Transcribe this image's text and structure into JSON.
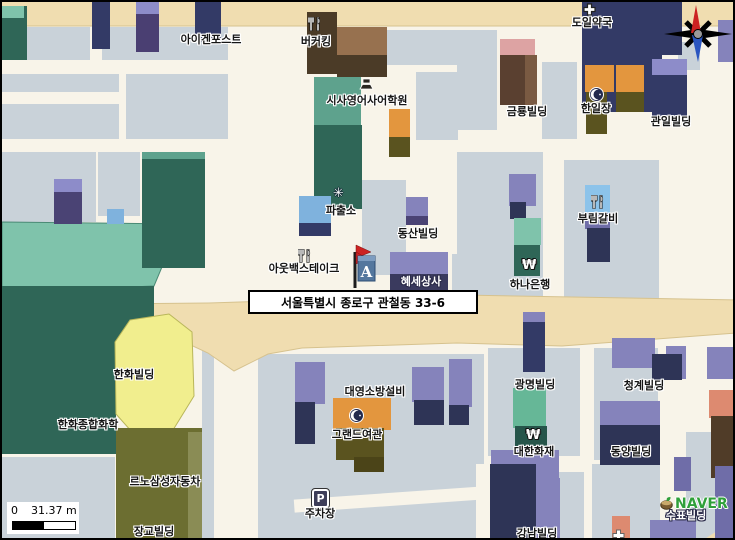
{
  "map": {
    "title_address": "서울특별시 종로구 관철동  33-6",
    "marker_letter": "A",
    "parking_letter": "P",
    "watermark": "NAVER",
    "scale_bar": {
      "zero": "0",
      "distance": "31.37 m"
    },
    "colors": {
      "road_tan": "#f0ddb0",
      "road_edge": "#d6c28e",
      "street_cream": "#f8f4e9",
      "block_gray": "#c9d2d9",
      "teal_light": "#7fc3ab",
      "teal_dark": "#2f6657",
      "yellow_bldg": "#f1ee8e",
      "yellow_edge": "#b9b65a",
      "olive_bldg": "#6c6e31",
      "navy": "#333a66",
      "purple": "#8583bb",
      "orange": "#e3963e",
      "compass_north": "#cc2222",
      "compass_south": "#2a55c0",
      "marker_flag": "#cc2222",
      "marker_box": "#54779e",
      "naver_green": "#2fa03a"
    },
    "blocks": [
      [
        0,
        25,
        88,
        33
      ],
      [
        0,
        72,
        117,
        18
      ],
      [
        0,
        102,
        117,
        35
      ],
      [
        100,
        25,
        126,
        33
      ],
      [
        124,
        72,
        102,
        65
      ],
      [
        0,
        150,
        94,
        70
      ],
      [
        96,
        150,
        42,
        64
      ],
      [
        385,
        28,
        73,
        35
      ],
      [
        414,
        70,
        42,
        68
      ],
      [
        360,
        178,
        44,
        95
      ],
      [
        450,
        252,
        60,
        42
      ],
      [
        455,
        28,
        40,
        100
      ],
      [
        540,
        60,
        35,
        77
      ],
      [
        676,
        40,
        22,
        28
      ],
      [
        455,
        150,
        86,
        147
      ],
      [
        562,
        158,
        95,
        140
      ],
      [
        256,
        352,
        226,
        188
      ],
      [
        486,
        346,
        92,
        108
      ],
      [
        482,
        470,
        100,
        70
      ],
      [
        592,
        346,
        64,
        112
      ],
      [
        590,
        462,
        68,
        78
      ],
      [
        684,
        430,
        51,
        110
      ],
      [
        0,
        455,
        113,
        85
      ],
      [
        200,
        342,
        12,
        198
      ]
    ],
    "streets": [
      [
        292,
        491,
        190,
        13,
        -4
      ],
      [
        474,
        462,
        16,
        78,
        0
      ]
    ],
    "buildings": [
      [
        0,
        4,
        25,
        54,
        "#2f6657"
      ],
      [
        0,
        4,
        22,
        12,
        "#7fc3ab"
      ],
      [
        90,
        0,
        18,
        47,
        "#333a66"
      ],
      [
        134,
        0,
        23,
        50,
        "#4a3f72"
      ],
      [
        134,
        0,
        23,
        12,
        "#8d8cc9"
      ],
      [
        193,
        0,
        26,
        40,
        "#333a66"
      ],
      [
        654,
        6,
        22,
        28,
        "#4a4374"
      ],
      [
        716,
        18,
        19,
        42,
        "#8583bb"
      ],
      [
        305,
        10,
        30,
        62,
        "#4b3b27"
      ],
      [
        335,
        25,
        50,
        28,
        "#97714f"
      ],
      [
        335,
        53,
        50,
        22,
        "#4b3b27"
      ],
      [
        312,
        75,
        47,
        50,
        "#5ea28d"
      ],
      [
        312,
        123,
        48,
        84,
        "#2f6657"
      ],
      [
        387,
        107,
        21,
        28,
        "#e3963e"
      ],
      [
        387,
        135,
        21,
        20,
        "#5a531f"
      ],
      [
        52,
        177,
        28,
        45,
        "#4a4374"
      ],
      [
        52,
        177,
        28,
        13,
        "#8d8cc9"
      ],
      [
        105,
        207,
        17,
        15,
        "#7fb2dd"
      ],
      [
        140,
        150,
        63,
        116,
        "#2f6657"
      ],
      [
        140,
        150,
        63,
        7,
        "#5ea28d"
      ],
      [
        297,
        194,
        32,
        27,
        "#7fb2dd"
      ],
      [
        297,
        221,
        32,
        13,
        "#333a66"
      ],
      [
        404,
        195,
        22,
        20,
        "#8583bb"
      ],
      [
        404,
        214,
        22,
        9,
        "#4a4374"
      ],
      [
        388,
        250,
        58,
        22,
        "#8987bf"
      ],
      [
        388,
        272,
        58,
        20,
        "#3a3a5e"
      ],
      [
        498,
        37,
        35,
        17,
        "#dda3a3"
      ],
      [
        498,
        53,
        25,
        50,
        "#5a4030"
      ],
      [
        523,
        53,
        12,
        50,
        "#7a5a42"
      ],
      [
        580,
        0,
        80,
        110,
        "#333a66"
      ],
      [
        660,
        0,
        20,
        53,
        "#333a66"
      ],
      [
        583,
        63,
        29,
        27,
        "#e3963e"
      ],
      [
        614,
        63,
        28,
        27,
        "#e3963e"
      ],
      [
        584,
        90,
        21,
        42,
        "#5a531f"
      ],
      [
        614,
        90,
        28,
        20,
        "#5a531f"
      ],
      [
        650,
        57,
        35,
        16,
        "#8d8cc9"
      ],
      [
        650,
        73,
        35,
        44,
        "#333a66"
      ],
      [
        583,
        183,
        25,
        28,
        "#8cc3ea"
      ],
      [
        583,
        211,
        25,
        16,
        "#6f6da8"
      ],
      [
        585,
        226,
        23,
        34,
        "#2e3456"
      ],
      [
        507,
        172,
        27,
        32,
        "#8583bb"
      ],
      [
        508,
        200,
        16,
        17,
        "#2e3456"
      ],
      [
        512,
        216,
        27,
        27,
        "#7fc3ab"
      ],
      [
        512,
        243,
        26,
        31,
        "#2f6657"
      ],
      [
        293,
        360,
        30,
        42,
        "#8583bb"
      ],
      [
        293,
        400,
        20,
        42,
        "#2e3456"
      ],
      [
        410,
        365,
        32,
        35,
        "#8583bb"
      ],
      [
        412,
        398,
        30,
        25,
        "#2e3456"
      ],
      [
        447,
        357,
        23,
        48,
        "#8583bb"
      ],
      [
        447,
        403,
        20,
        20,
        "#2e3456"
      ],
      [
        114,
        426,
        86,
        114,
        "#6c6e31"
      ],
      [
        186,
        430,
        14,
        110,
        "#8a8c55"
      ],
      [
        331,
        396,
        58,
        32,
        "#e3963e"
      ],
      [
        334,
        426,
        48,
        32,
        "#5a531f"
      ],
      [
        352,
        455,
        30,
        15,
        "#4b4418"
      ],
      [
        488,
        468,
        22,
        64,
        "#2e3456"
      ],
      [
        521,
        310,
        22,
        11,
        "#8583bb"
      ],
      [
        521,
        320,
        22,
        50,
        "#333a66"
      ],
      [
        511,
        386,
        33,
        40,
        "#66b797"
      ],
      [
        513,
        424,
        32,
        21,
        "#26554a"
      ],
      [
        489,
        448,
        68,
        28,
        "#8583bb"
      ],
      [
        488,
        462,
        46,
        78,
        "#2e3456"
      ],
      [
        534,
        476,
        24,
        64,
        "#8583bb"
      ],
      [
        610,
        336,
        43,
        30,
        "#8583bb"
      ],
      [
        664,
        344,
        20,
        33,
        "#8583bb"
      ],
      [
        650,
        352,
        30,
        26,
        "#2e3456"
      ],
      [
        598,
        399,
        60,
        26,
        "#8583bb"
      ],
      [
        598,
        423,
        60,
        40,
        "#2e3456"
      ],
      [
        672,
        455,
        17,
        34,
        "#6f6da8"
      ],
      [
        705,
        345,
        28,
        32,
        "#8583bb"
      ],
      [
        707,
        388,
        28,
        28,
        "#dd8a70"
      ],
      [
        709,
        414,
        26,
        62,
        "#503c28"
      ],
      [
        610,
        514,
        18,
        26,
        "#dd8a70"
      ],
      [
        648,
        518,
        46,
        22,
        "#8583bb"
      ],
      [
        713,
        464,
        22,
        76,
        "#6f6da8"
      ]
    ],
    "icons": [
      {
        "k": "restaurant",
        "x": 306,
        "y": 15,
        "name": "restaurant-icon-burger-king"
      },
      {
        "k": "pharmacy",
        "x": 581,
        "y": 1,
        "name": "pharmacy-cross-icon"
      },
      {
        "k": "school",
        "x": 357,
        "y": 75,
        "name": "academy-icon"
      },
      {
        "k": "police",
        "x": 331,
        "y": 185,
        "name": "police-badge-icon"
      },
      {
        "k": "moon",
        "x": 587,
        "y": 85,
        "name": "lodging-moon-icon"
      },
      {
        "k": "restaurant",
        "x": 589,
        "y": 193,
        "name": "restaurant-icon-burim"
      },
      {
        "k": "restaurant",
        "x": 296,
        "y": 247,
        "name": "restaurant-icon-outback"
      },
      {
        "k": "won",
        "x": 520,
        "y": 257,
        "name": "bank-won-icon"
      },
      {
        "k": "moon",
        "x": 347,
        "y": 406,
        "name": "lodging-moon-icon"
      },
      {
        "k": "won",
        "x": 524,
        "y": 427,
        "name": "insurance-won-icon"
      },
      {
        "k": "parking",
        "x": 310,
        "y": 487,
        "name": "parking-icon"
      },
      {
        "k": "crosssmall",
        "x": 610,
        "y": 527,
        "name": "small-cross-icon"
      },
      {
        "k": "naver",
        "x": 658,
        "y": 495,
        "name": "naver-logo"
      }
    ],
    "labels": [
      {
        "t": "아이겐포스트",
        "x": 209,
        "y": 32
      },
      {
        "t": "버커킹",
        "x": 314,
        "y": 34
      },
      {
        "t": "도일약국",
        "x": 590,
        "y": 15
      },
      {
        "t": "시사영어사어학원",
        "x": 365,
        "y": 93
      },
      {
        "t": "금룡빌딩",
        "x": 525,
        "y": 104
      },
      {
        "t": "한일장",
        "x": 594,
        "y": 101
      },
      {
        "t": "관일빌딩",
        "x": 669,
        "y": 114
      },
      {
        "t": "파출소",
        "x": 339,
        "y": 203
      },
      {
        "t": "동산빌딩",
        "x": 416,
        "y": 226
      },
      {
        "t": "부림갈비",
        "x": 596,
        "y": 211
      },
      {
        "t": "아웃백스테이크",
        "x": 302,
        "y": 261
      },
      {
        "t": "혜세상사",
        "x": 419,
        "y": 274,
        "s": "w"
      },
      {
        "t": "하나은행",
        "x": 528,
        "y": 277
      },
      {
        "t": "한화빌딩",
        "x": 132,
        "y": 367
      },
      {
        "t": "한화종합화학",
        "x": 86,
        "y": 417
      },
      {
        "t": "르노삼성자동차",
        "x": 163,
        "y": 474
      },
      {
        "t": "장교빌딩",
        "x": 152,
        "y": 524
      },
      {
        "t": "대영소방설비",
        "x": 373,
        "y": 384
      },
      {
        "t": "그랜드여관",
        "x": 355,
        "y": 427
      },
      {
        "t": "주차장",
        "x": 318,
        "y": 506
      },
      {
        "t": "광명빌딩",
        "x": 533,
        "y": 377
      },
      {
        "t": "청계빌딩",
        "x": 642,
        "y": 378
      },
      {
        "t": "대한화재",
        "x": 532,
        "y": 444
      },
      {
        "t": "동양빌딩",
        "x": 629,
        "y": 444
      },
      {
        "t": "강남빌딩",
        "x": 535,
        "y": 526
      },
      {
        "t": "수표빌딩",
        "x": 684,
        "y": 508,
        "s": "w"
      }
    ]
  }
}
